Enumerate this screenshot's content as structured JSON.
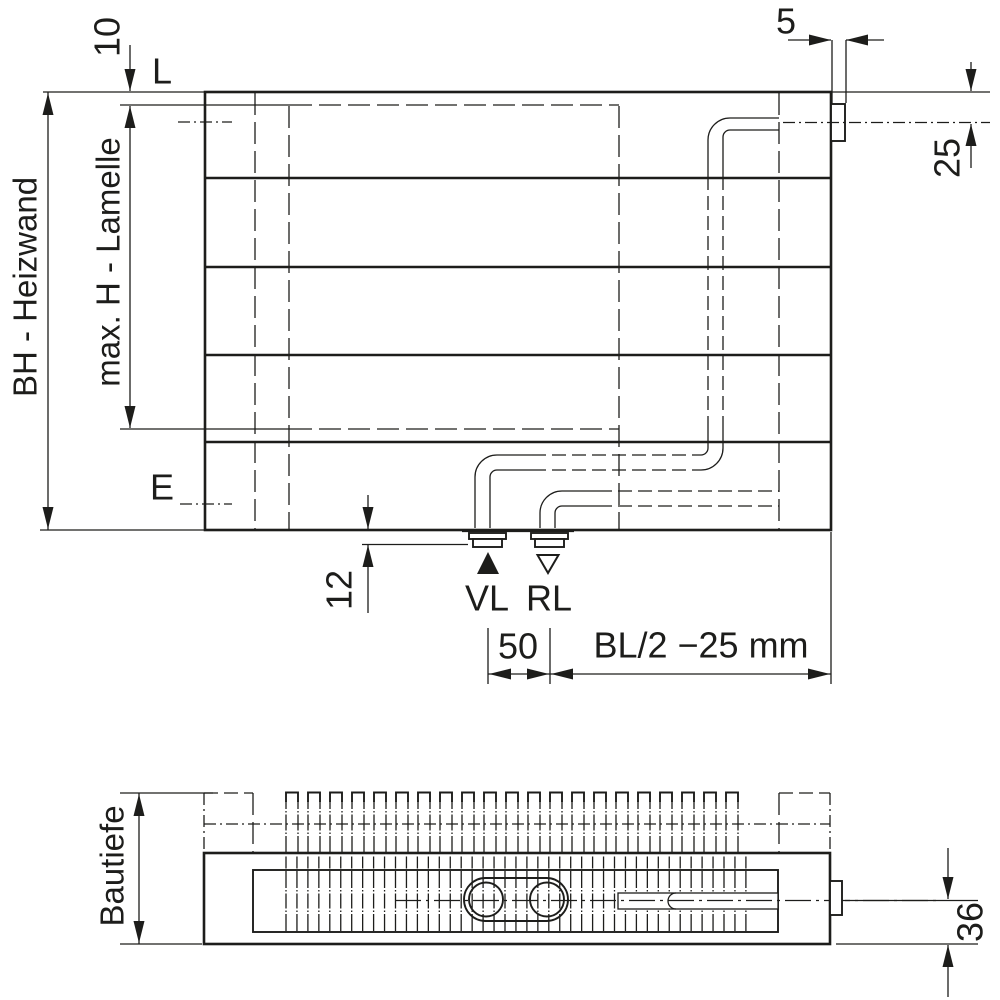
{
  "meta": {
    "drawing_type": "radiator dimensional technical drawing",
    "colors": {
      "line": "#1d1d1b",
      "background": "#ffffff"
    }
  },
  "front": {
    "dim_10": "10",
    "label_l": "L",
    "dim_bh": "BH - Heizwand",
    "dim_max_h": "max. H - Lamelle",
    "label_e": "E",
    "dim_5": "5",
    "dim_25": "25",
    "dim_12": "12",
    "label_vl": "VL",
    "label_rl": "RL",
    "dim_50": "50",
    "dim_bl": "BL/2 −25 mm"
  },
  "section": {
    "dim_bautiefe": "Bautiefe",
    "dim_36": "36"
  }
}
